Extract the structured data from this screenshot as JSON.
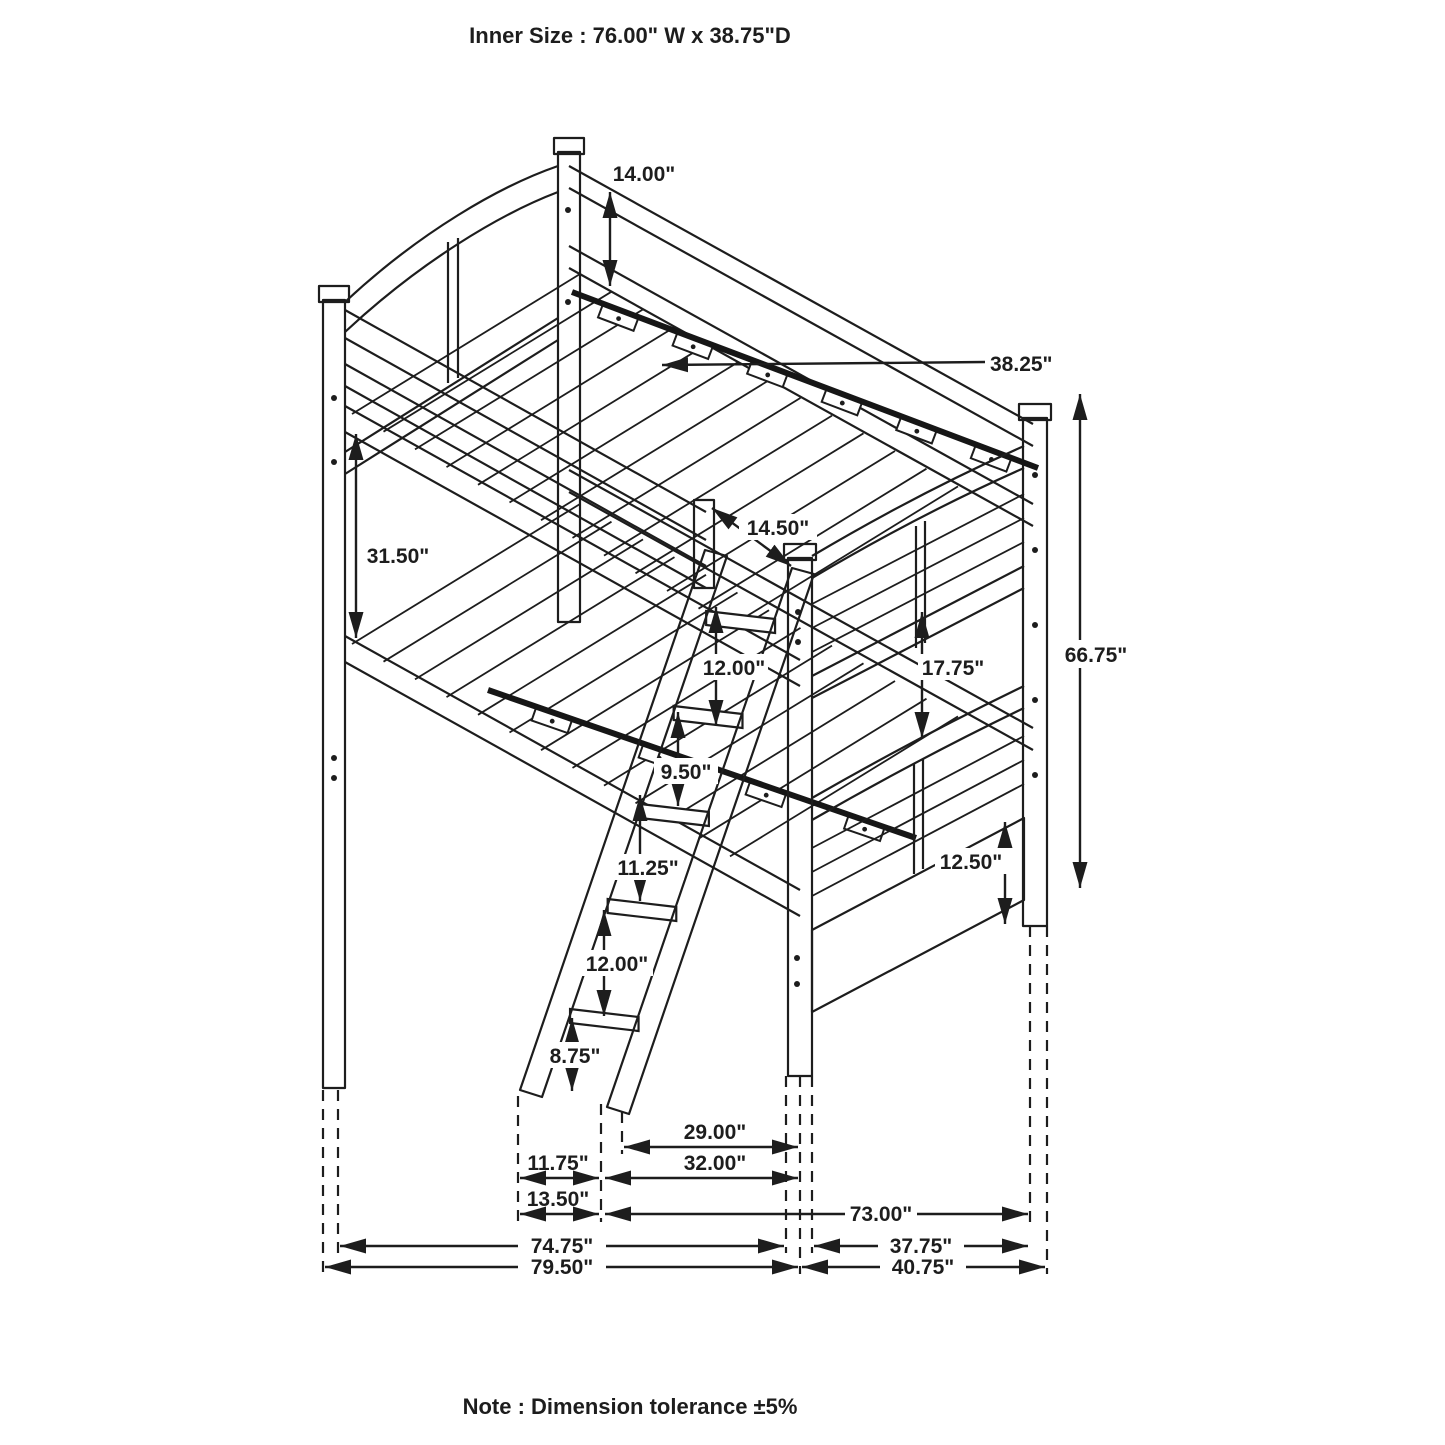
{
  "title": "Inner Size : 76.00\" W x  38.75\"D",
  "note": "Note : Dimension tolerance ±5%",
  "colors": {
    "ink": "#1d1d1d",
    "background": "#ffffff"
  },
  "dims": {
    "headboard_top": "14.00\"",
    "slat_depth": "38.25\"",
    "bunk_clearance": "31.50\"",
    "guardrail_height": "14.50\"",
    "ladder_top_spacing": "12.00\"",
    "footboard_gap": "17.75\"",
    "overall_height": "66.75\"",
    "rung_spacing_1": "9.50\"",
    "rung_spacing_2": "11.25\"",
    "rung_spacing_3": "12.00\"",
    "rung_floor_gap": "8.75\"",
    "footboard_rail": "12.50\"",
    "ladder_reach": "29.00\"",
    "ladder_foot_width": "11.75\"",
    "ladder_reach_outer": "32.00\"",
    "ladder_foot_outer": "13.50\"",
    "frame_length": "73.00\"",
    "length_inner": "74.75\"",
    "depth_inner": "37.75\"",
    "overall_length": "79.50\"",
    "overall_depth": "40.75\""
  }
}
